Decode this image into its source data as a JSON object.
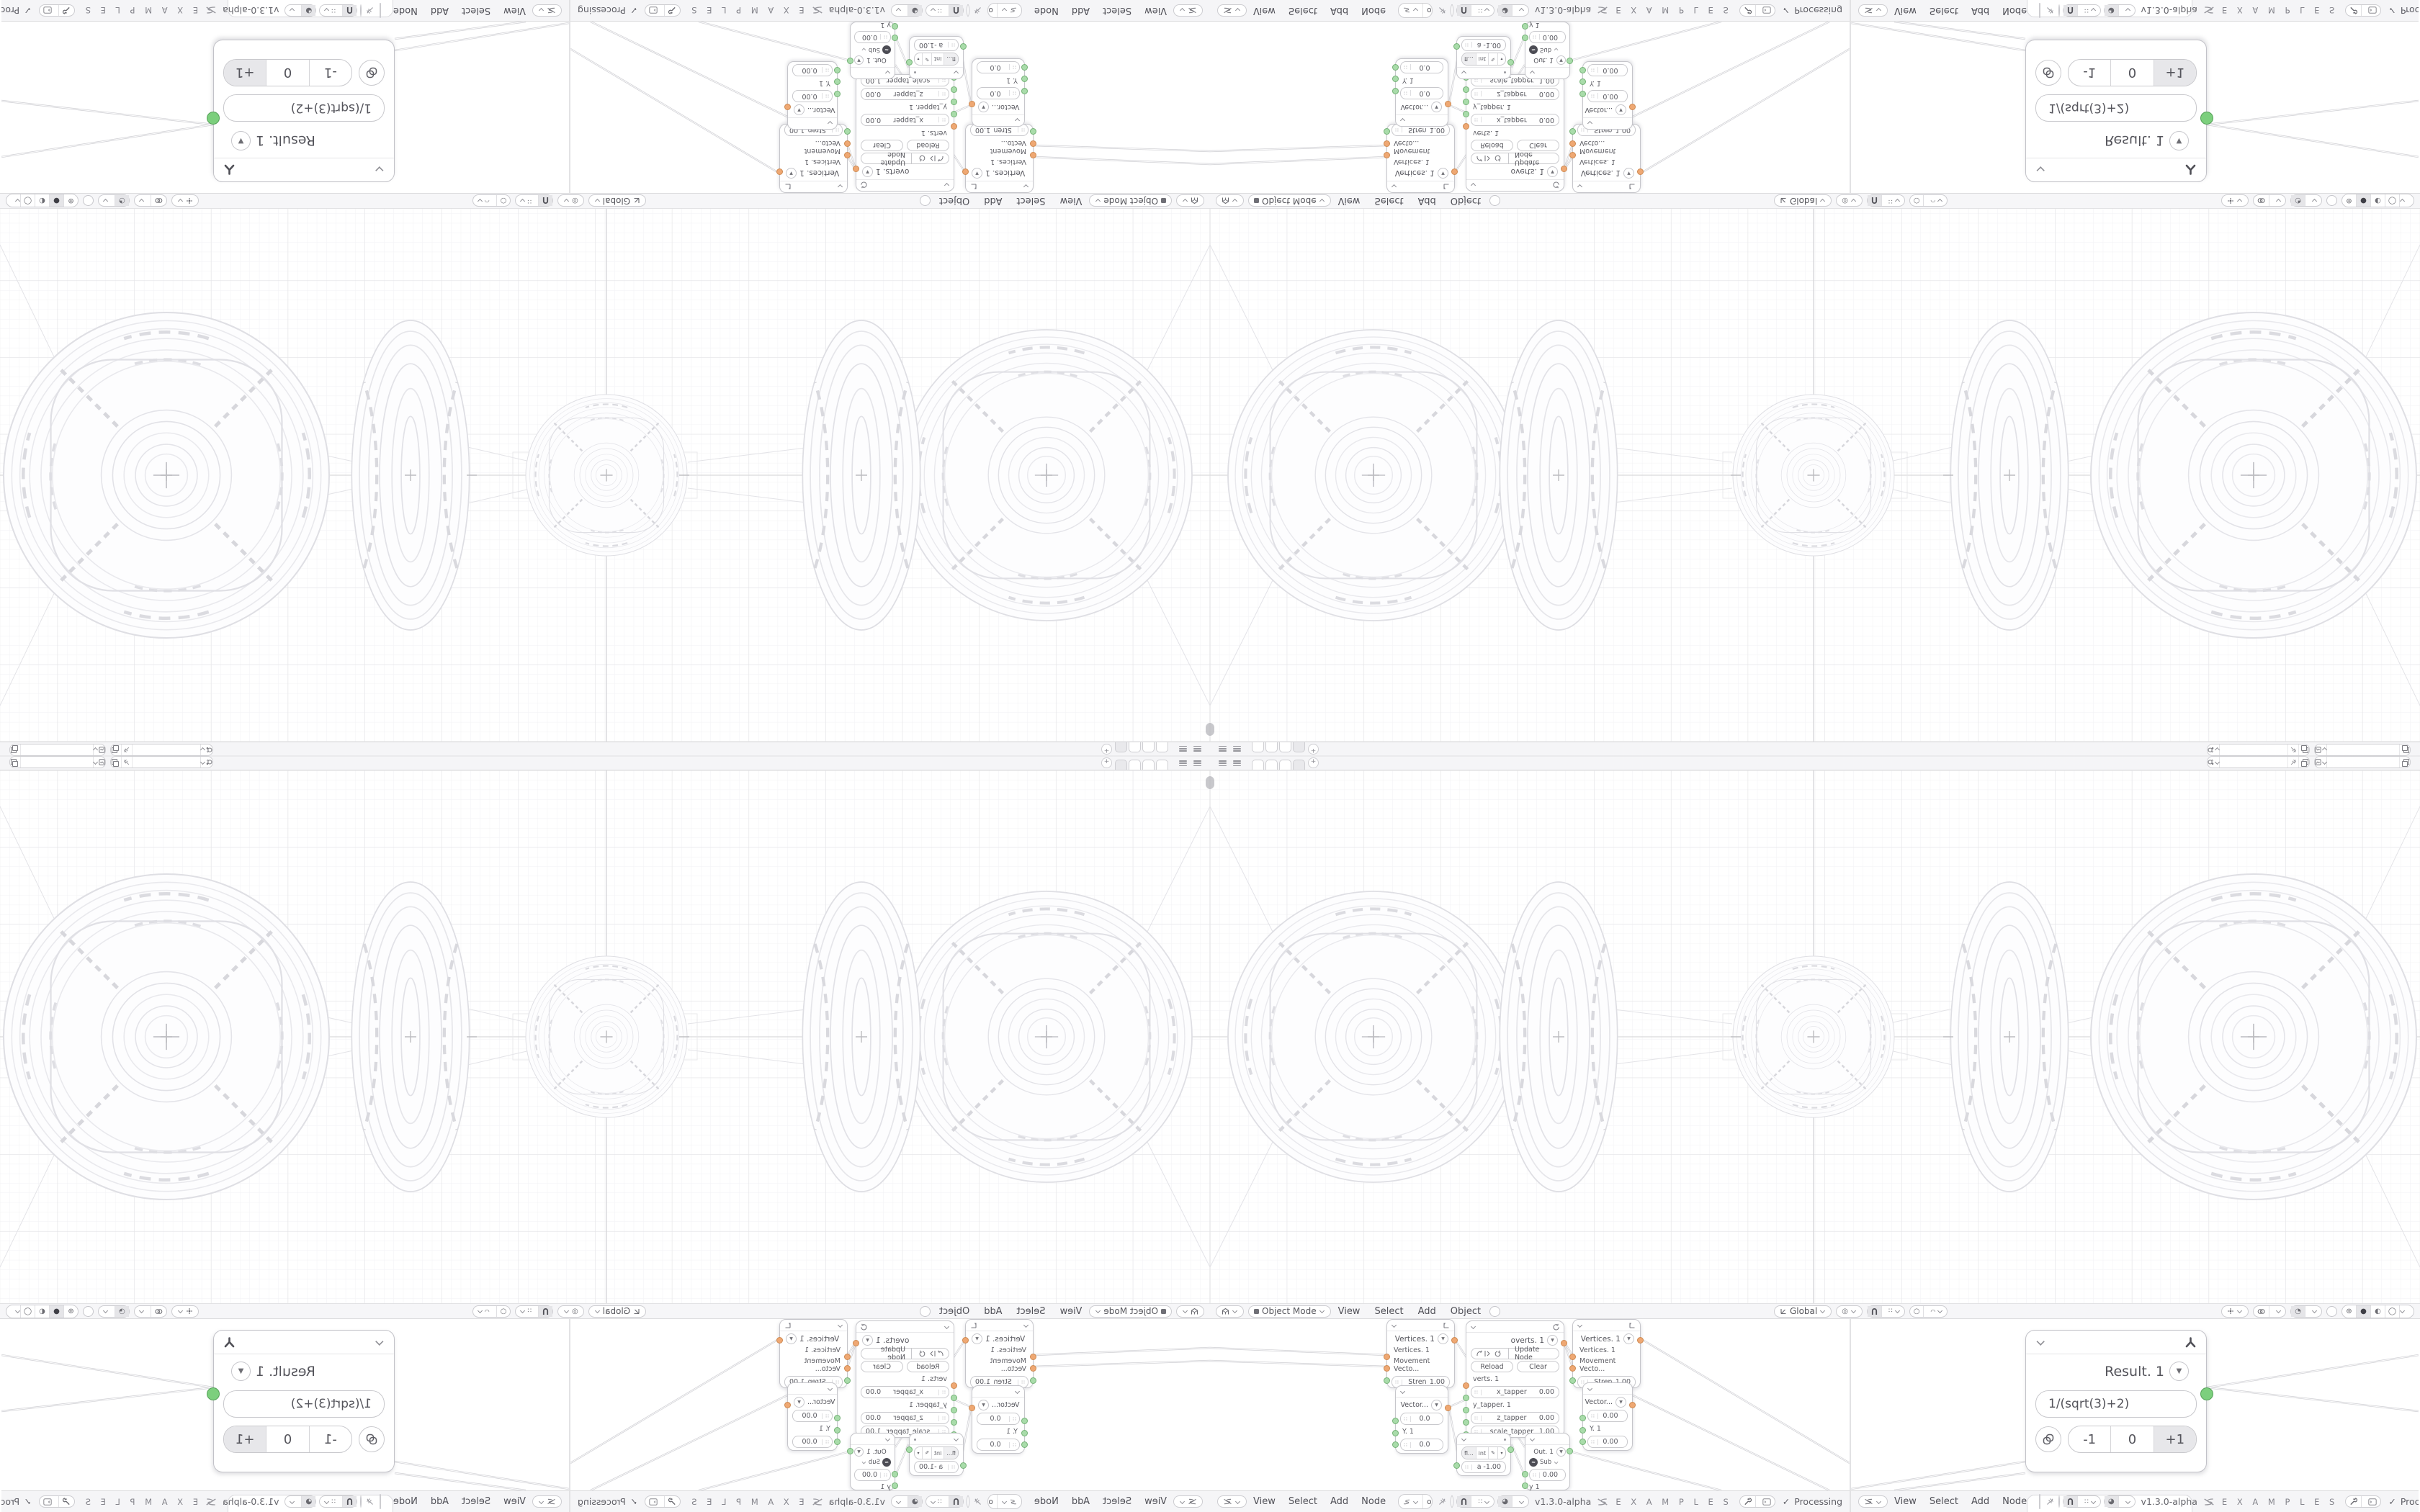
{
  "topbar": {
    "new_workspace": "+",
    "workspace_tabs": [
      "",
      "",
      "",
      ""
    ],
    "scene_field": "",
    "view_layer_field": ""
  },
  "viewport": {
    "header": {
      "mode": "Object Mode",
      "view": "View",
      "select": "Select",
      "add": "Add",
      "object": "Object",
      "orientation": "Global"
    }
  },
  "node_editor": {
    "header": {
      "view": "View",
      "select": "Select",
      "add": "Add",
      "node": "Node",
      "tree_1": "оΔо2S:✚ƆC✚ЯRоЯR✚ƆC✚:S2оΔо",
      "tree_2": "ƎE",
      "version": "v1.3.0-alpha",
      "examples": "E X A M P L E S",
      "processing": "Processing",
      "check": "✓"
    }
  },
  "nodes": {
    "vertices": {
      "title": "Vertices. 1",
      "in1": "Vertices. 1",
      "in2": "Movement Vecto...",
      "stren_label": "Stren",
      "stren_value": "1.00"
    },
    "script": {
      "title": "overts. 1",
      "update": "Update Node",
      "reload": "Reload",
      "clear": "Clear",
      "in_verts": "verts. 1",
      "x_label": "x_tapper",
      "x_value": "0.00",
      "y_label": "y_tapper. 1",
      "z_label": "z_tapper",
      "z_value": "0.00",
      "scale_label": "scale_tapper",
      "scale_value": "1.00"
    },
    "vector_a": {
      "title": "Vector...",
      "v1": "0.0",
      "y": "Y. 1",
      "v2": "0.0"
    },
    "vector_b": {
      "title": "Vector...",
      "v1": "0.00",
      "y": "Y. 1",
      "v2": "0.00"
    },
    "number": {
      "mode_float": "fl...",
      "mode_int": "int",
      "label": "a",
      "value": "-1.00"
    },
    "out": {
      "title": "Out. 1",
      "op": "Sub",
      "value": "0.00",
      "y": "y 1"
    },
    "result": {
      "title": "Result. 1",
      "formula": "1/(sqrt(3)+2)",
      "btn_minus": "-1",
      "btn_zero": "0",
      "btn_plus": "+1"
    }
  },
  "colors": {
    "socket_green": "#a9dcaa",
    "socket_orange": "#efa873",
    "result_socket": "#7ccf7d",
    "active_segment": "#e7e7ea",
    "wire": "#d2d2d6"
  }
}
